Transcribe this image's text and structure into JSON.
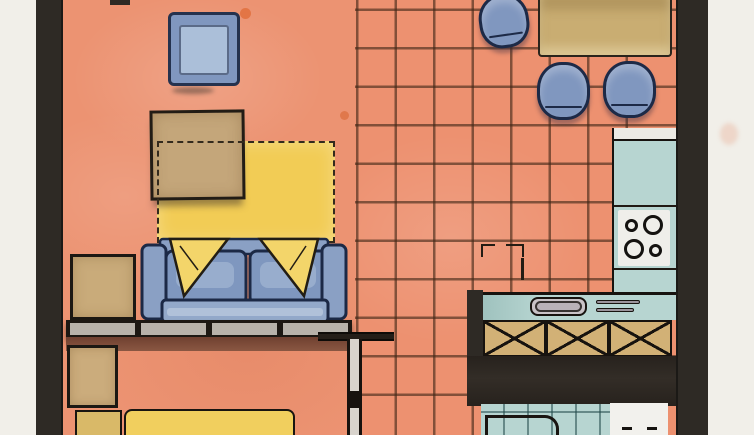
{
  "meta": {
    "description": "Scanned hand-drawn watercolor apartment floor plan; no text labels, dimensions or UI controls are visible in the image"
  },
  "colors": {
    "paper": "#f1efe9",
    "wall": "#2e2a25",
    "floor": "#ec9372",
    "tileLine": "rgba(64,39,22,0.62)",
    "blue": "#8097bf",
    "blueLight": "#abbfd9",
    "navy": "#25324e",
    "yellow": "#f2cc55",
    "tan": "#c8a977",
    "teal": "#b7d5d1",
    "panelGrey": "#b8b2aa",
    "brown": "#7c4c37",
    "ink": "#17130f",
    "fixtureWhite": "#f2f1ed",
    "sinkGrey": "#c9c3c7"
  },
  "rooms": [
    {
      "name": "living-area",
      "floor": "salmon watercolor wash"
    },
    {
      "name": "kitchen-dining-area",
      "floor": "terracotta tile grid"
    },
    {
      "name": "bedroom",
      "floor": "salmon watercolor wash"
    },
    {
      "name": "bathroom",
      "floor": "teal tile grid"
    }
  ],
  "furniture": [
    {
      "name": "armchair",
      "color": "blue"
    },
    {
      "name": "coffee-table",
      "color": "tan"
    },
    {
      "name": "area-rug",
      "color": "yellow",
      "outline": "dashed"
    },
    {
      "name": "sofa",
      "color": "blue",
      "cushions": 2,
      "pillows": 2
    },
    {
      "name": "side-table",
      "color": "tan"
    },
    {
      "name": "sideboard-console",
      "panels": 4
    },
    {
      "name": "nightstand",
      "color": "tan"
    },
    {
      "name": "bed",
      "color": "yellow"
    },
    {
      "name": "dining-table",
      "color": "tan"
    },
    {
      "name": "stool",
      "count": 3,
      "color": "blue"
    },
    {
      "name": "cooktop",
      "burners": 4
    },
    {
      "name": "kitchen-sink"
    },
    {
      "name": "base-cabinets",
      "doors": 3,
      "marking": "X"
    },
    {
      "name": "bathroom-fixture",
      "color": "white"
    }
  ]
}
